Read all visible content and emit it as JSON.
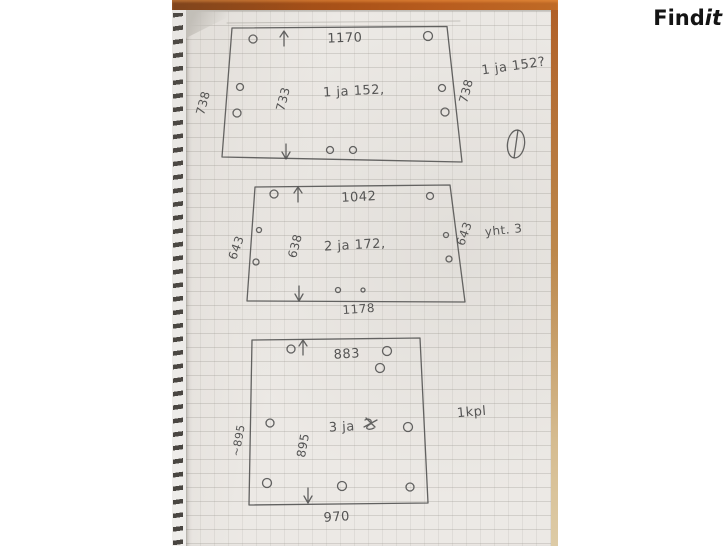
{
  "watermark": {
    "brand_regular": "Find",
    "brand_italic": "it"
  },
  "colors": {
    "ink": "#4d4d4d",
    "paper": "#ece9e5",
    "table_wood": "#a44e16",
    "logo": "#141414"
  },
  "margin_note": "1 ja 152?",
  "pieces": [
    {
      "id": "piece-1",
      "top_width": "1170",
      "label": "1 ja 152,",
      "left_outer": "738",
      "left_inner": "733",
      "right_outer": "738"
    },
    {
      "id": "piece-2",
      "top_width": "1042",
      "label": "2 ja 172,",
      "left_outer": "643",
      "left_inner": "638",
      "right_outer": "643",
      "bottom_width": "1178",
      "note": "yht. 3"
    },
    {
      "id": "piece-3",
      "top_width": "883",
      "label": "3 ja",
      "left_outer": "~895",
      "left_inner": "895",
      "bottom_width": "970",
      "note": "1kpl"
    }
  ]
}
